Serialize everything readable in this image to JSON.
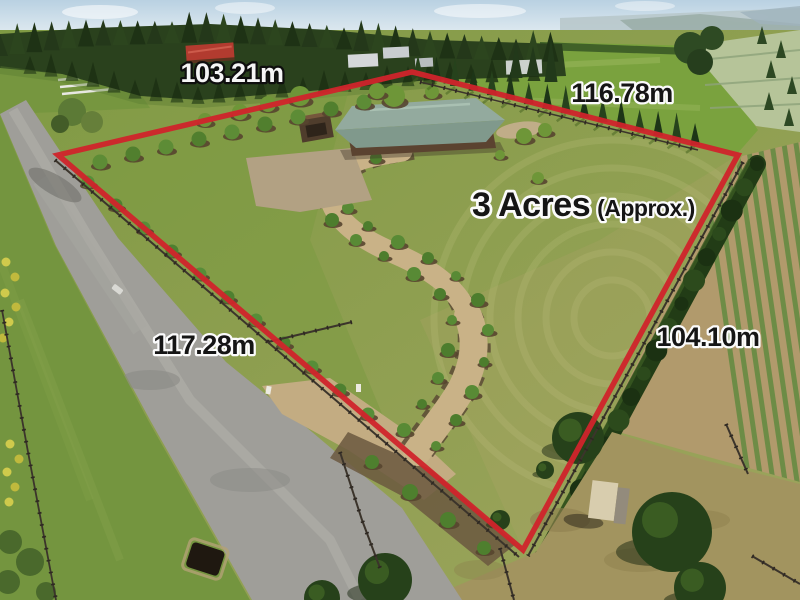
{
  "photo": {
    "kind": "aerial-property-listing-photo",
    "boundary_color": "#d0242b",
    "area_label": {
      "value": "3 Acres",
      "qualifier": "(Approx.)"
    },
    "measurements": {
      "top_left": "103.21m",
      "top_right": "116.78m",
      "bottom_left": "117.28m",
      "right": "104.10m"
    }
  }
}
